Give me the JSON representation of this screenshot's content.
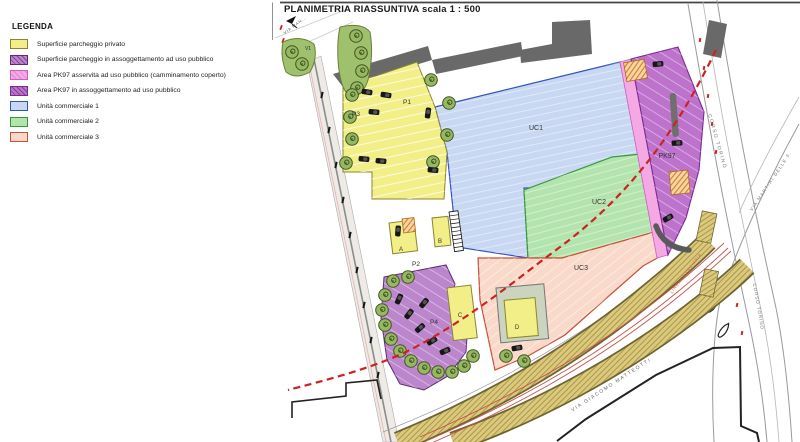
{
  "title": "PLANIMETRIA RIASSUNTIVA scala 1 : 500",
  "legend": {
    "heading": "LEGENDA",
    "items": [
      {
        "label": "Superficie parcheggio privato",
        "fill": "#f2ef88",
        "border": "#8a852f"
      },
      {
        "label": "Superficie parcheggio in assoggettamento ad uso pubblico",
        "fill": "#bb86cc",
        "border": "#5e2a74"
      },
      {
        "label": "Area PK97 asservita ad uso pubblico (camminamento coperto)",
        "fill": "#f4a8e4",
        "border": "#c95fc0"
      },
      {
        "label": "Area PK97 in assoggettamento ad uso pubblico",
        "fill": "#bd72cc",
        "border": "#7a2a92"
      },
      {
        "label": "Unità commerciale 1",
        "fill": "#c8d7f2",
        "border": "#2f55c0"
      },
      {
        "label": "Unità commerciale 2",
        "fill": "#b4e4ad",
        "border": "#35973a"
      },
      {
        "label": "Unità commerciale 3",
        "fill": "#f9d9c9",
        "border": "#cc4e35"
      }
    ]
  },
  "plan": {
    "labels": {
      "uc1": "UC1",
      "uc2": "UC2",
      "uc3": "UC3",
      "pk97": "PK97",
      "p1": "P1",
      "p2": "P2",
      "p3": "P3",
      "p4": "P4",
      "unit_a": "A",
      "unit_b": "B",
      "unit_c": "C",
      "unit_d": "D",
      "v1": "V1"
    },
    "streets": {
      "via_man": "VIA MAN...",
      "corso_torino_upper": "CORSO TORINO",
      "corso_torino_lower": "CORSO TORINO",
      "via_martiri": "VIA MARTIRI DELLE F.",
      "via_matteotti": "VIA GIACOMO MATTEOTTI",
      "linea_tranviaria": "LINEA TRANVIARIA"
    },
    "colors": {
      "building": "#696969",
      "tree": "#97b863",
      "tree_stroke": "#43551f",
      "tram_band": "#dbca7e",
      "tram_edge": "#6e6433",
      "tram_rail": "#c2554a",
      "boundary_red": "#cc2222",
      "road": "#8c8c8c"
    }
  }
}
